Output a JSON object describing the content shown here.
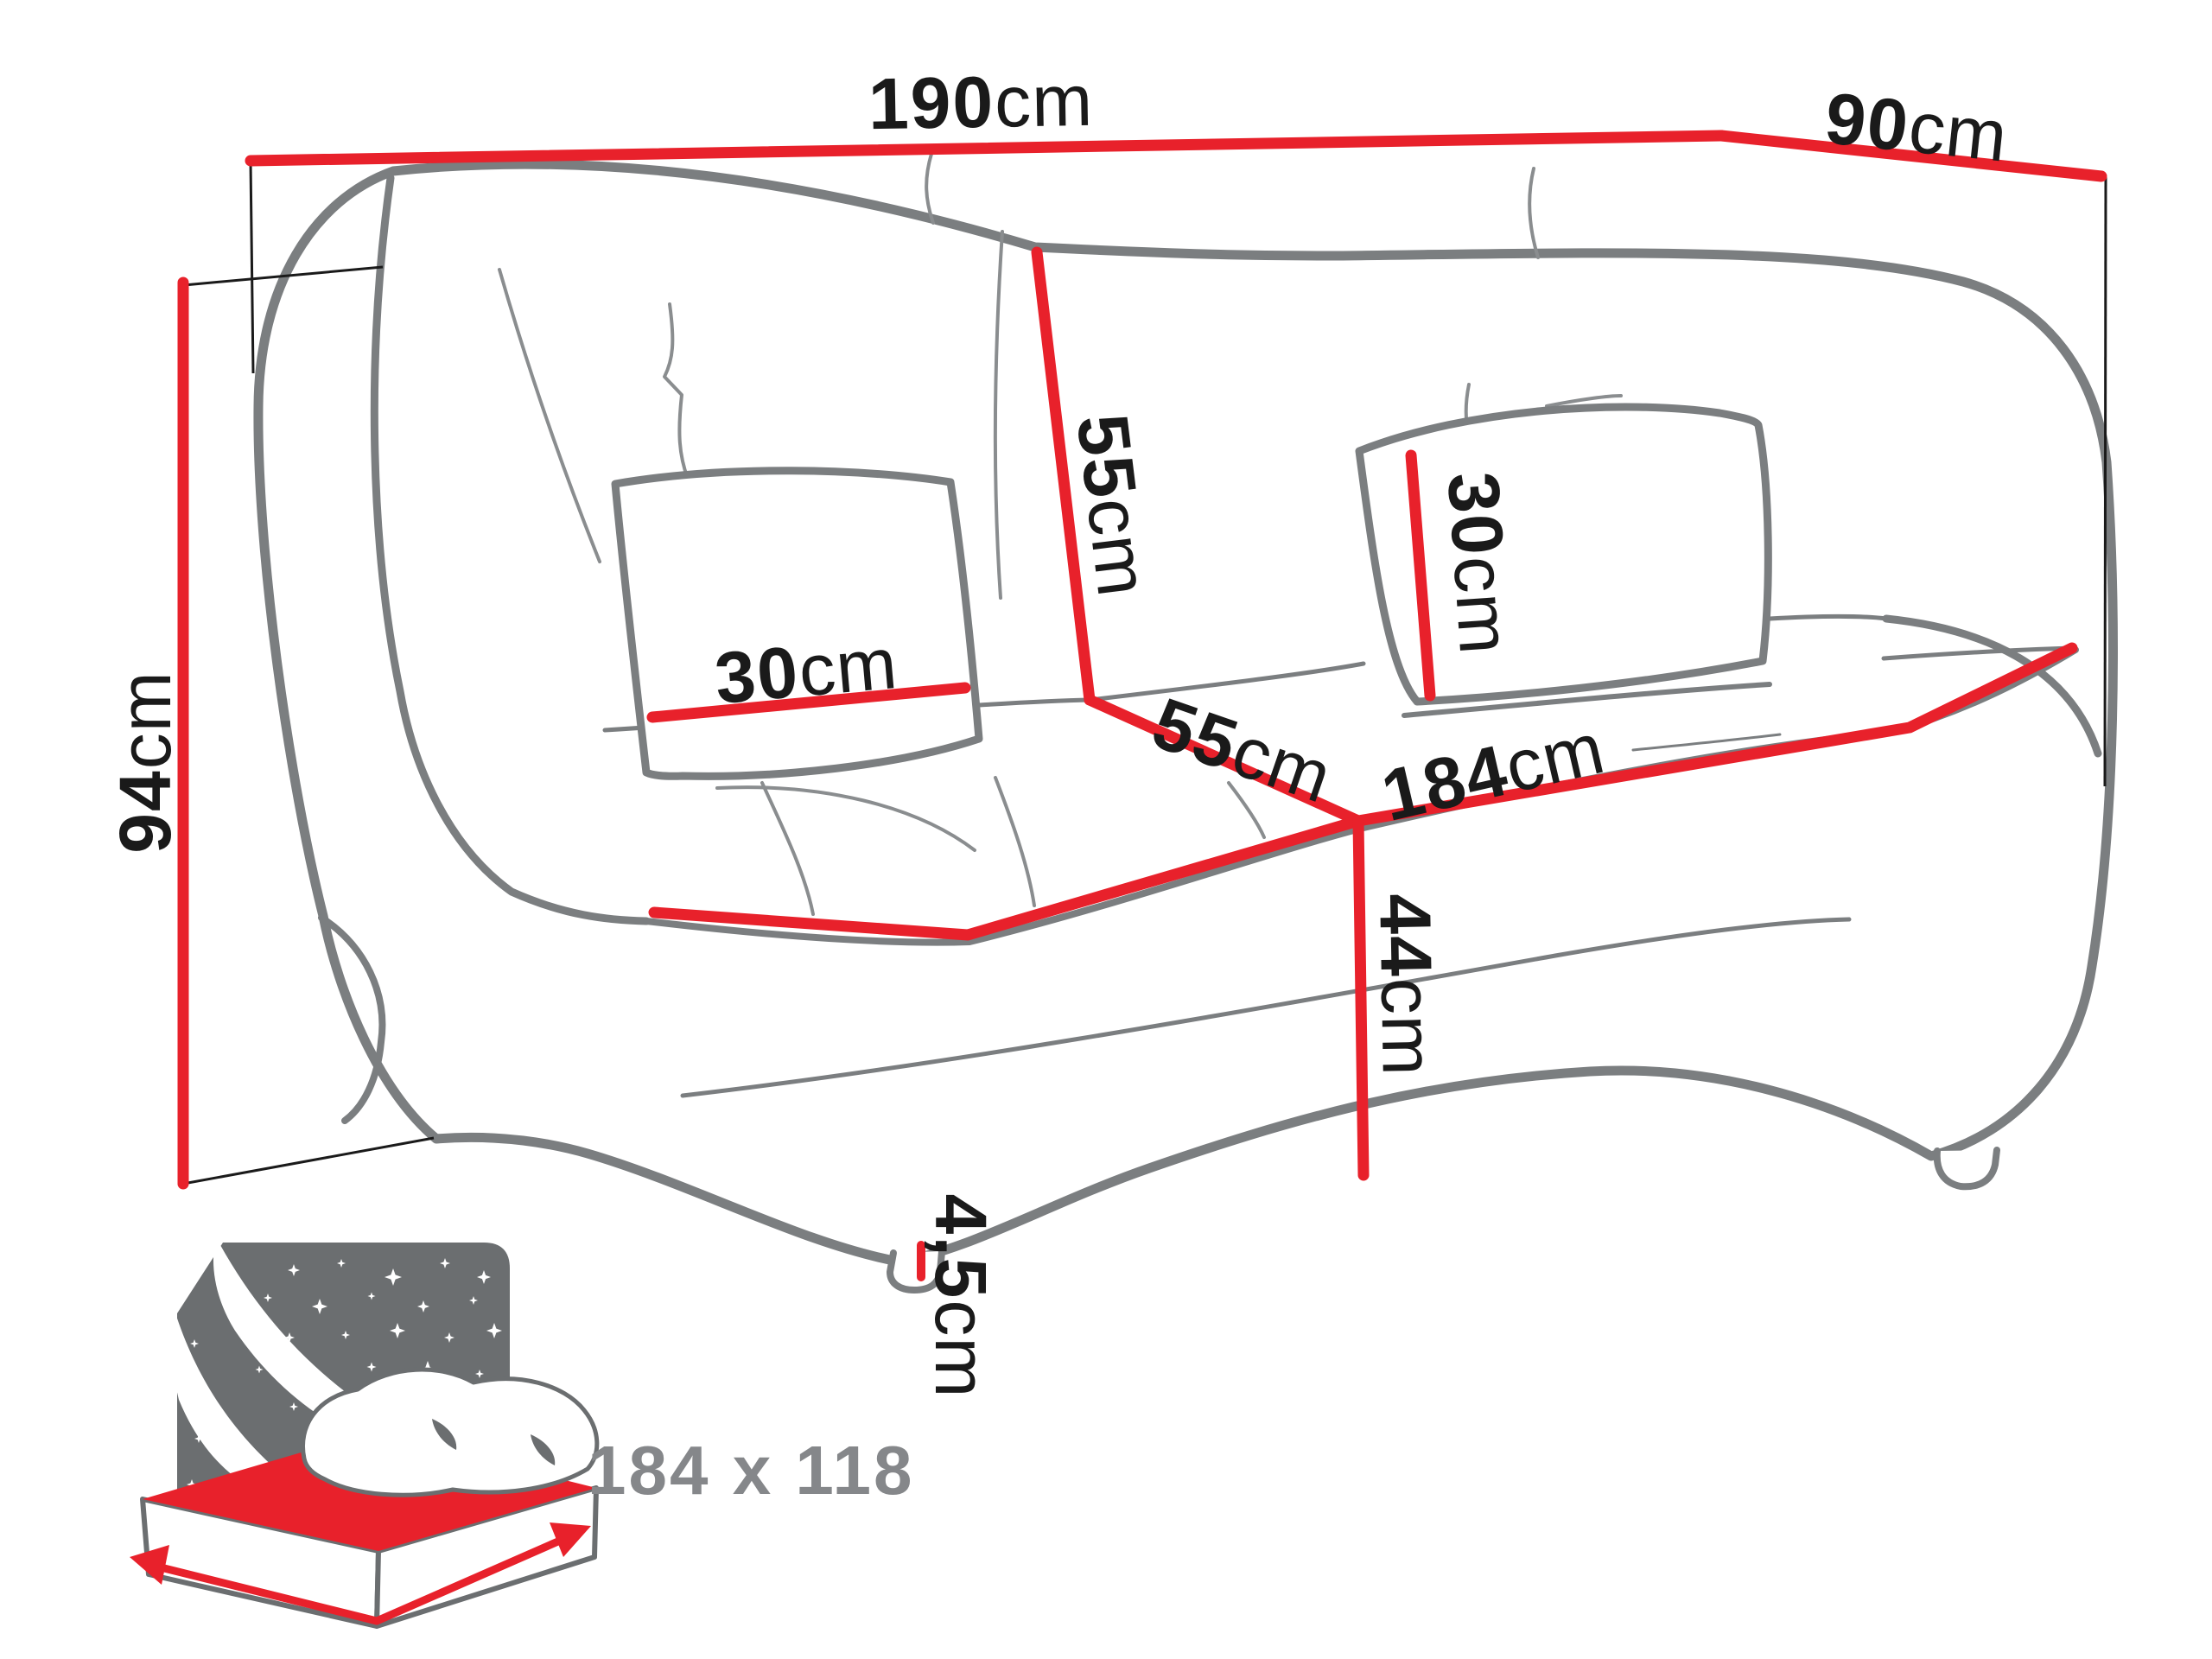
{
  "diagram": {
    "title_note": "sofa dimension drawing",
    "dimensions": {
      "overall_width": {
        "value": "190",
        "unit": "cm"
      },
      "overall_depth": {
        "value": "90",
        "unit": "cm"
      },
      "overall_height": {
        "value": "94",
        "unit": "cm"
      },
      "backrest_height": {
        "value": "55",
        "unit": "cm"
      },
      "seat_depth": {
        "value": "55",
        "unit": "cm"
      },
      "seat_width": {
        "value": "184",
        "unit": "cm"
      },
      "seat_height": {
        "value": "44",
        "unit": "cm"
      },
      "pillow_left": {
        "value": "30",
        "unit": "cm"
      },
      "pillow_right": {
        "value": "30",
        "unit": "cm"
      },
      "leg_height": {
        "value": "4,5",
        "unit": "cm"
      }
    },
    "sleeping_area": {
      "label": "184 x 118"
    },
    "colors": {
      "dimension_red": "#e8212b",
      "outline_gray": "#7b7e80",
      "seam_gray": "#8a8d8f",
      "text_black": "#1a1a1a",
      "label_gray": "#85878a",
      "icon_panel_gray": "#6b6e70"
    }
  }
}
